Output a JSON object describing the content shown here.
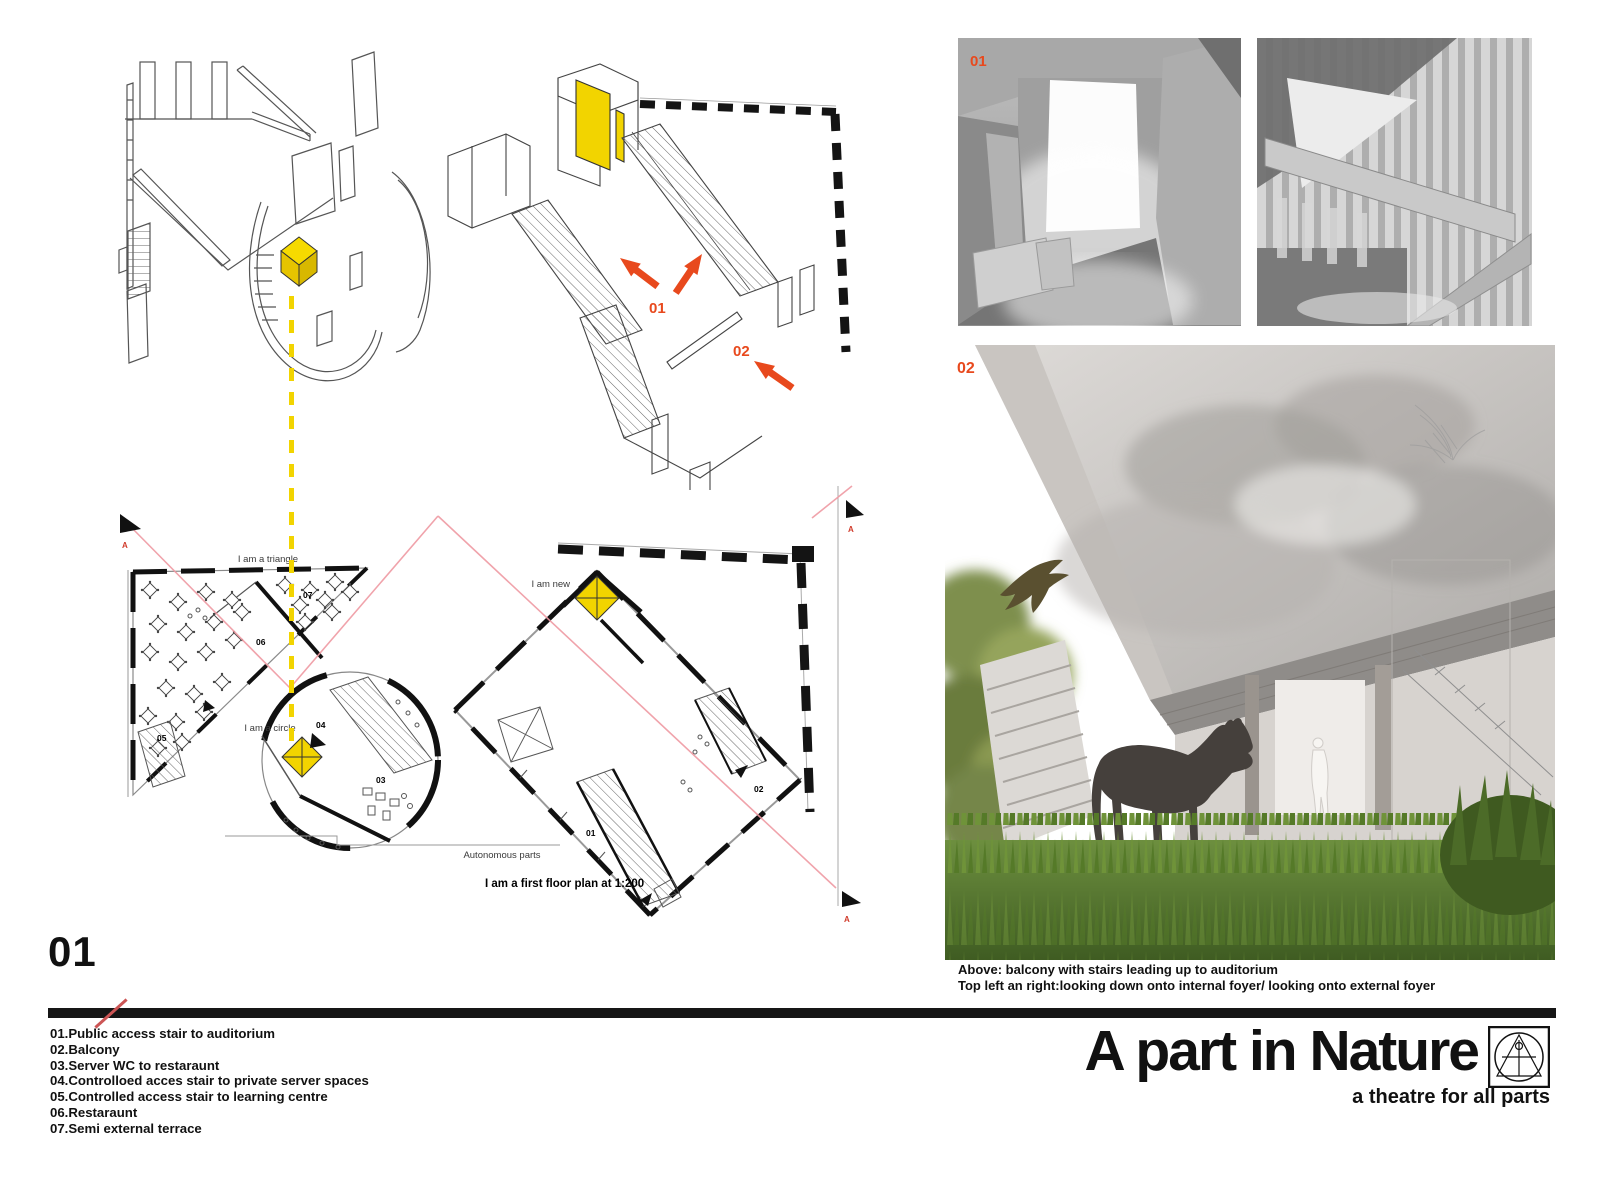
{
  "page": {
    "number": "01",
    "title": "A part in Nature",
    "subtitle": "a theatre for all parts"
  },
  "colors": {
    "accent_red": "#e8491d",
    "highlight_yellow": "#f2d400",
    "section_line_pink": "#ef9aa3"
  },
  "axonometric": {
    "callouts": [
      {
        "label": "01"
      },
      {
        "label": "02"
      }
    ]
  },
  "plans": {
    "labels": {
      "triangle": "I am a triangle",
      "circle": "I am a circle",
      "new": "I am new",
      "autonomous": "Autonomous parts",
      "scale_caption": "I am a first floor plan at 1:200"
    },
    "section_marker": "A",
    "room_numbers": [
      "01",
      "02",
      "03",
      "04",
      "05",
      "06",
      "07"
    ]
  },
  "photos": {
    "top_left_label": "01",
    "large_label": "02",
    "captions": [
      "Above: balcony with stairs leading up to auditorium",
      "Top left an right:looking down onto internal foyer/ looking onto external foyer"
    ]
  },
  "legend": {
    "items": [
      "01.Public access stair to auditorium",
      "02.Balcony",
      "03.Server WC to restaraunt",
      "04.Controlloed acces stair to private server spaces",
      "05.Controlled access stair to learning centre",
      "06.Restaraunt",
      "07.Semi external terrace"
    ]
  }
}
